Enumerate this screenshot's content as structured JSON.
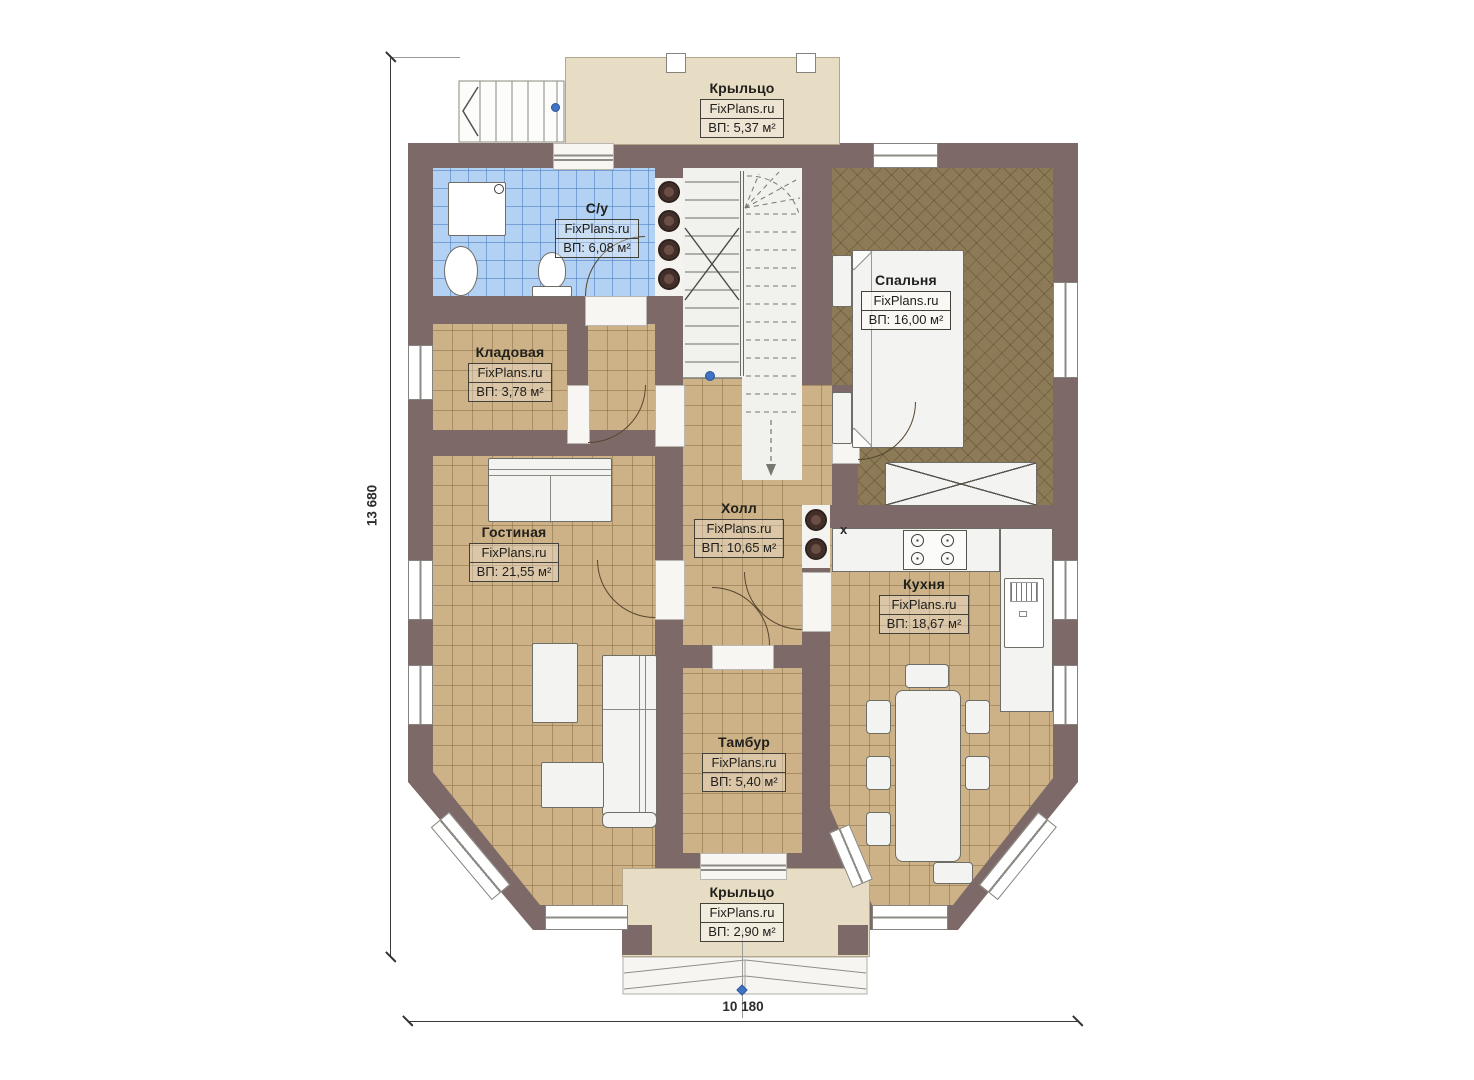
{
  "plan": {
    "brand": "FixPlans.ru",
    "rooms": [
      {
        "id": "porch-top",
        "name": "Крыльцо",
        "brand": "FixPlans.ru",
        "area": "ВП: 5,37 м²"
      },
      {
        "id": "bathroom",
        "name": "С/у",
        "brand": "FixPlans.ru",
        "area": "ВП: 6,08 м²"
      },
      {
        "id": "bedroom",
        "name": "Спальня",
        "brand": "FixPlans.ru",
        "area": "ВП: 16,00 м²"
      },
      {
        "id": "storage",
        "name": "Кладовая",
        "brand": "FixPlans.ru",
        "area": "ВП: 3,78 м²"
      },
      {
        "id": "living-room",
        "name": "Гостиная",
        "brand": "FixPlans.ru",
        "area": "ВП: 21,55 м²"
      },
      {
        "id": "hall",
        "name": "Холл",
        "brand": "FixPlans.ru",
        "area": "ВП: 10,65 м²"
      },
      {
        "id": "kitchen",
        "name": "Кухня",
        "brand": "FixPlans.ru",
        "area": "ВП: 18,67 м²"
      },
      {
        "id": "vestibule",
        "name": "Тамбур",
        "brand": "FixPlans.ru",
        "area": "ВП: 5,40 м²"
      },
      {
        "id": "porch-bottom",
        "name": "Крыльцо",
        "brand": "FixPlans.ru",
        "area": "ВП: 2,90 м²"
      }
    ],
    "dimensions": {
      "height": "13 680",
      "width": "10 180"
    },
    "annotations": {
      "x_mark": "x"
    },
    "colors": {
      "wall": "#7d6a68",
      "floor": "#cdb287",
      "bathroom_floor": "#b3d1f2",
      "bedroom_floor": "#8d7a56",
      "porch": "#e7dcc4",
      "marker_blue": "#3f74c2"
    }
  }
}
